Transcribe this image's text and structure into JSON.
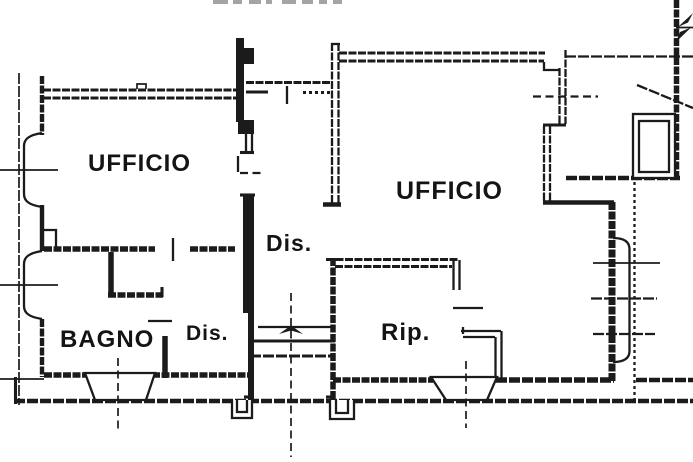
{
  "floorplan": {
    "background_color": "#ffffff",
    "line_color": "#1b1b1b",
    "rooms": [
      {
        "key": "ufficio-left",
        "label": "UFFICIO"
      },
      {
        "key": "ufficio-right",
        "label": "UFFICIO"
      },
      {
        "key": "dis-central",
        "label": "Dis."
      },
      {
        "key": "bagno",
        "label": "BAGNO"
      },
      {
        "key": "dis-lobby",
        "label": "Dis."
      },
      {
        "key": "rip",
        "label": "Rip."
      }
    ]
  }
}
